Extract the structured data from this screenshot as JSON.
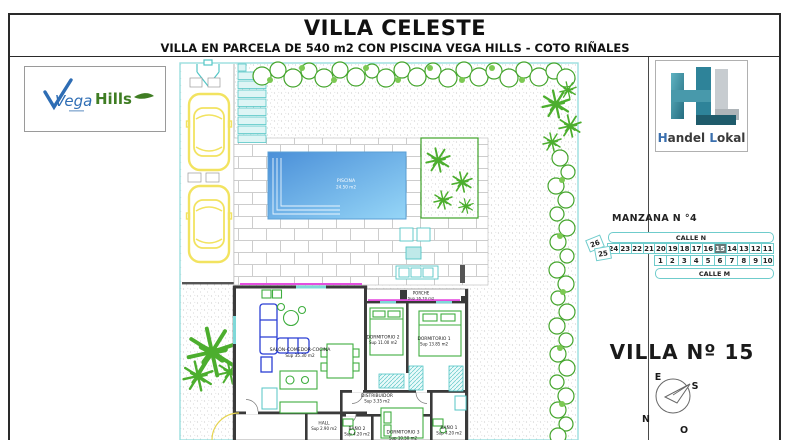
{
  "header": {
    "title": "VILLA CELESTE",
    "subtitle": "VILLA EN PARCELA DE 540 m2 CON PISCINA VEGA HILLS - COTO RIÑALES"
  },
  "logos": {
    "vega_hills": {
      "word1": "Vega",
      "word2": "Hills"
    },
    "handel_lokal": {
      "initial1": "H",
      "rest1": "andel",
      "initial2": "L",
      "rest2": "okal"
    }
  },
  "site_plan": {
    "pool": {
      "label": "PISCINA",
      "area": "24.50 m2"
    },
    "rooms": {
      "porche": {
        "name": "PORCHE",
        "area": "Sup 16.70 m2"
      },
      "salon": {
        "name": "SALÓN-COMEDOR-COCINA",
        "area": "Sup 35.30 m2"
      },
      "dormitorio2": {
        "name": "DORMITORIO 2",
        "area": "Sup 11.00 m2"
      },
      "dormitorio1": {
        "name": "DORMITORIO 1",
        "area": "Sup 13.85 m2"
      },
      "distribuidor": {
        "name": "DISTRIBUIDOR",
        "area": "Sup 3.35 m2"
      },
      "hall": {
        "name": "HALL",
        "area": "Sup 2.90 m2"
      },
      "bano2": {
        "name": "BAÑO 2",
        "area": "Sup 4.20 m2"
      },
      "dormitorio3": {
        "name": "DORMITORIO 3",
        "area": "Sup 10.50 m2"
      },
      "bano1": {
        "name": "BAÑO 1",
        "area": "Sup 4.20 m2"
      }
    }
  },
  "manzana": {
    "title": "MANZANA N °4",
    "street_top": "CALLE N",
    "street_bottom": "CALLE M",
    "row_top": [
      "24",
      "23",
      "22",
      "21",
      "20",
      "19",
      "18",
      "17",
      "16",
      "15",
      "14",
      "13",
      "12",
      "11"
    ],
    "row_bottom": [
      "1",
      "2",
      "3",
      "4",
      "5",
      "6",
      "7",
      "8",
      "9",
      "10"
    ],
    "side_plots": [
      "26",
      "25"
    ],
    "highlighted_plot": "15"
  },
  "villa_label": "VILLA Nº 15",
  "compass": {
    "top": "E",
    "right": "S",
    "bottom": "O",
    "left": "N"
  },
  "colors": {
    "cyan_line": "#6fcccc",
    "plant_green": "#4cae2e",
    "pool_dark": "#4a8fd8",
    "pool_light": "#96d6f7",
    "magenta_wall": "#e44fe0",
    "car_yellow": "#f2e360",
    "highlight_plot_bg": "#687878",
    "wall_dark": "#3a3a3a"
  }
}
